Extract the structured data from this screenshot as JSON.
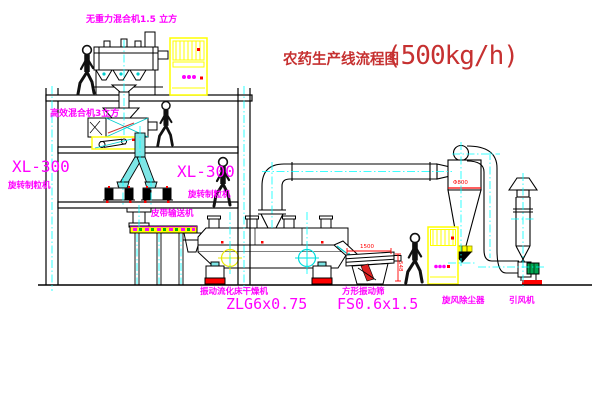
{
  "title": {
    "main": "农药生产线流程图",
    "capacity": "(500kg/h)"
  },
  "labels": {
    "mixer_top": "无重力混合机1.5 立方",
    "mixer_fl2": "高效混合机3立方",
    "granulator_left_model": "XL-300",
    "granulator_left_name": "旋转制粒机",
    "granulator_right_model": "XL-300",
    "granulator_right_name": "旋转制粒机",
    "belt_conveyor": "皮带输送机",
    "dryer_name": "振动流化床干燥机",
    "dryer_model": "ZLG6x0.75",
    "sieve_name": "方形振动筛",
    "sieve_model": "FS0.6x1.5",
    "cyclone": "旋风除尘器",
    "fan": "引风机"
  },
  "dimensions": {
    "sieve_length": "1500",
    "sieve_height": "548",
    "cyclone_diameter": "Φ800"
  },
  "colors": {
    "label_magenta": "#ff00ff",
    "title_red": "#c63131",
    "centerline_cyan": "#00ffff",
    "cabinet_yellow": "#ffff00",
    "chute_cyan_fill": "#7ee6e6",
    "motor_green": "#00a550",
    "detail_red": "#ff0000",
    "line_black": "#000000"
  }
}
